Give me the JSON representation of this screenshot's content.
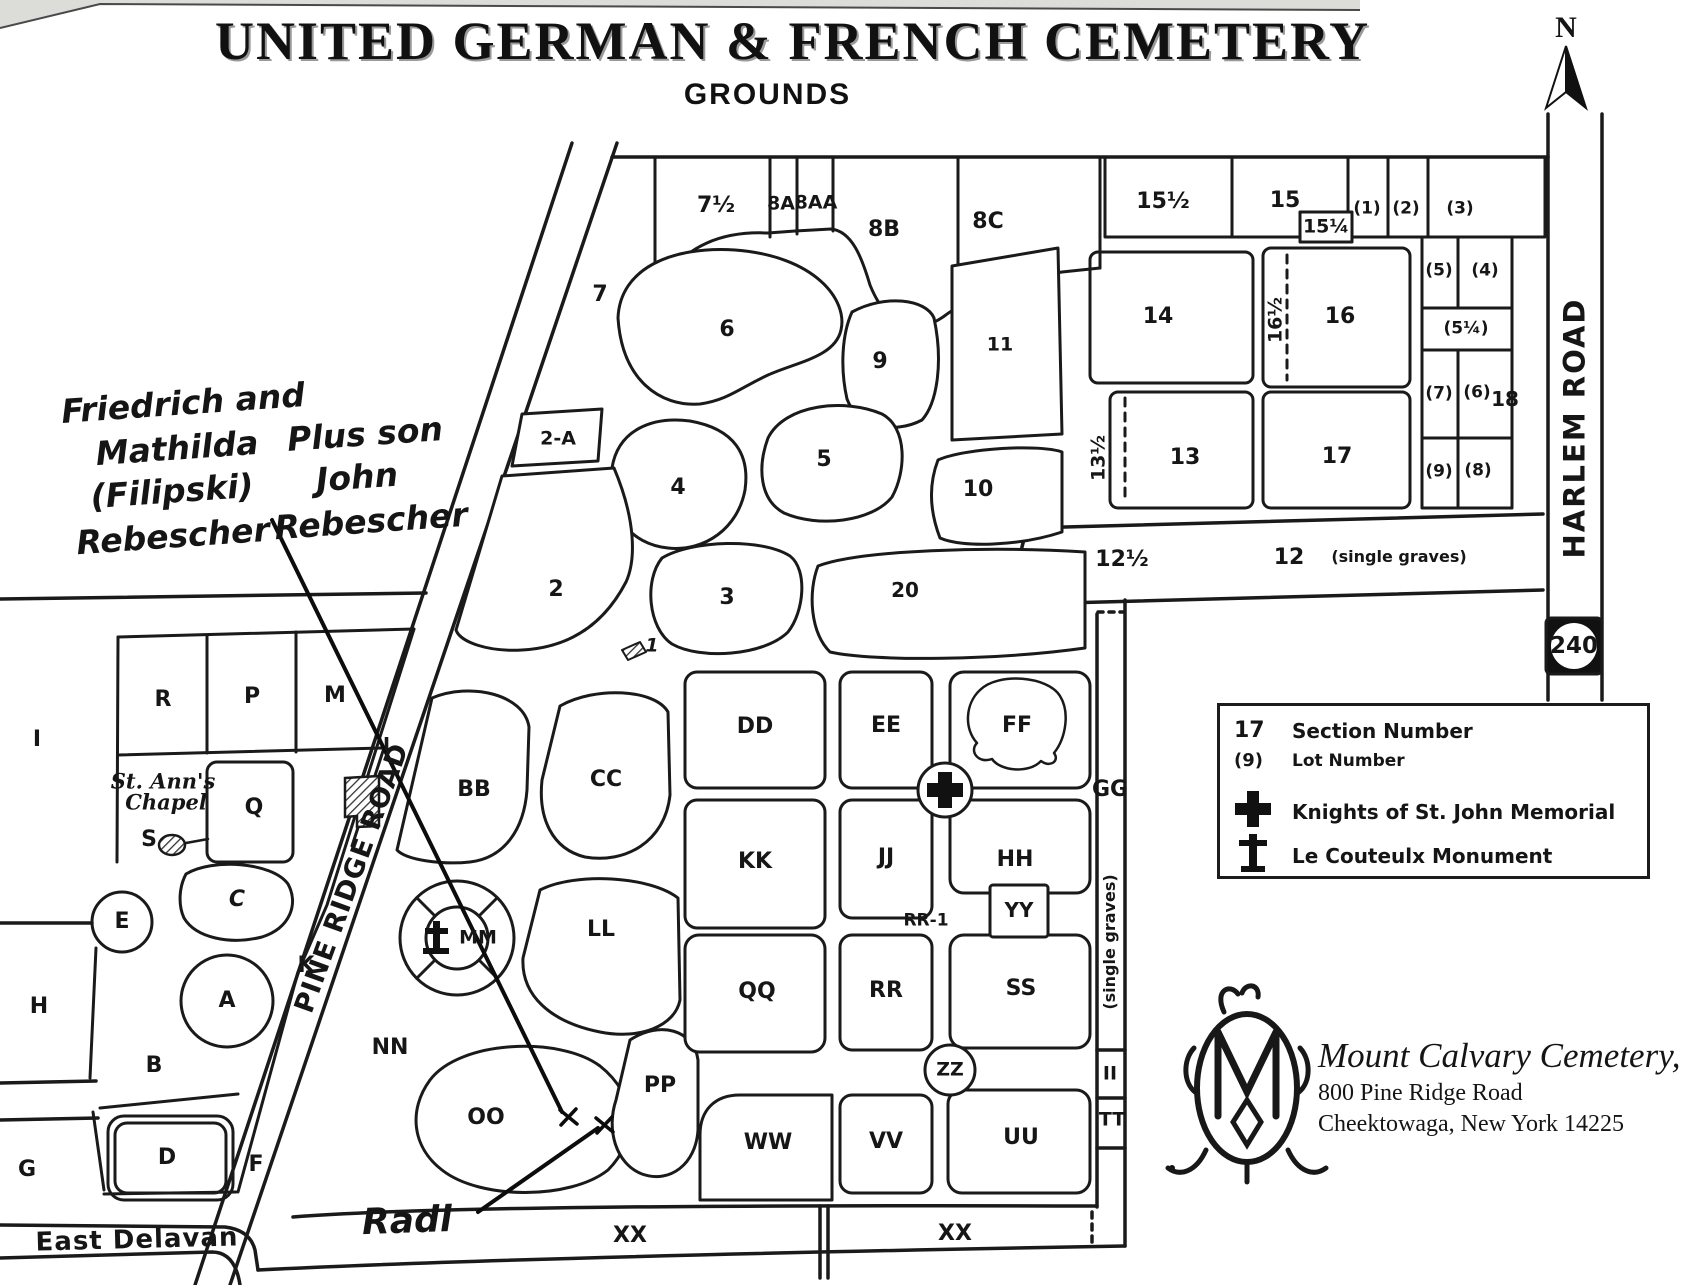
{
  "title": {
    "main": "UNITED GERMAN & FRENCH CEMETERY",
    "sub": "GROUNDS"
  },
  "compass": {
    "north": "N"
  },
  "roads": {
    "harlem_road": "HARLEM ROAD",
    "route_240": "240",
    "pine_ridge_road": "PINE RIDGE ROAD",
    "east_delavan": "East Delavan"
  },
  "legend": {
    "section_sample": "17",
    "section_label": "Section Number",
    "lot_sample": "(9)",
    "lot_label": "Lot Number",
    "knights_label": "Knights of St. John Memorial",
    "couteulx_label": "Le Couteulx Monument"
  },
  "logo_block": {
    "company": "Mount Calvary Cemetery, Inc.",
    "address_line1": "800 Pine Ridge Road",
    "address_line2": "Cheektowaga, New York 14225"
  },
  "annotations": {
    "rebescher_line1": "Friedrich and",
    "rebescher_line2": "Mathilda",
    "rebescher_line3": "(Filipski)",
    "rebescher_line4": "Rebescher",
    "john_line1": "Plus son",
    "john_line2": "John",
    "john_line3": "Rebescher",
    "radl": "Radl"
  },
  "chapel": {
    "line1": "St. Ann's",
    "line2": "Chapel"
  },
  "s": {
    "n7": "7",
    "n7h": "7½",
    "n8a": "8A",
    "n8aa": "8AA",
    "n8b": "8B",
    "n8c": "8C",
    "n15h": "15½",
    "n15": "15",
    "n15q": "15¼",
    "np1": "(1)",
    "np2": "(2)",
    "np3": "(3)",
    "n6": "6",
    "n9": "9",
    "n11": "11",
    "n14": "14",
    "n16h": "16½",
    "n16": "16",
    "np5": "(5)",
    "np4": "(4)",
    "np5q": "(5¼)",
    "np7": "(7)",
    "np6": "(6)",
    "n18": "18",
    "np9": "(9)",
    "np8": "(8)",
    "n2a": "2-A",
    "n4": "4",
    "n5": "5",
    "n10": "10",
    "n13h": "13½",
    "n13": "13",
    "n17": "17",
    "n2": "2",
    "n3": "3",
    "n20": "20",
    "n12h": "12½",
    "n12": "12",
    "sg_a": "(single graves)",
    "sg_b": "(single graves)",
    "n1": "1",
    "lI": "I",
    "lR": "R",
    "lP": "P",
    "lM": "M",
    "lQ": "Q",
    "lS": "S",
    "lC": "C",
    "lE": "E",
    "lA": "A",
    "lH": "H",
    "lB": "B",
    "lK": "K",
    "lG": "G",
    "lD": "D",
    "lF": "F",
    "lL": "L",
    "bBB": "BB",
    "bCC": "CC",
    "bDD": "DD",
    "bEE": "EE",
    "bFF": "FF",
    "bGG": "GG",
    "bKK": "KK",
    "bJJ": "JJ",
    "bHH": "HH",
    "bYY": "YY",
    "bRR1": "RR-1",
    "bLL": "LL",
    "bMM": "MM",
    "bNN": "NN",
    "bQQ": "QQ",
    "bRR": "RR",
    "bSS": "SS",
    "bZZ": "ZZ",
    "bOO": "OO",
    "bPP": "PP",
    "bWW": "WW",
    "bVV": "VV",
    "bUU": "UU",
    "bII": "II",
    "bTT": "TT",
    "bXX1": "XX",
    "bXX2": "XX"
  }
}
